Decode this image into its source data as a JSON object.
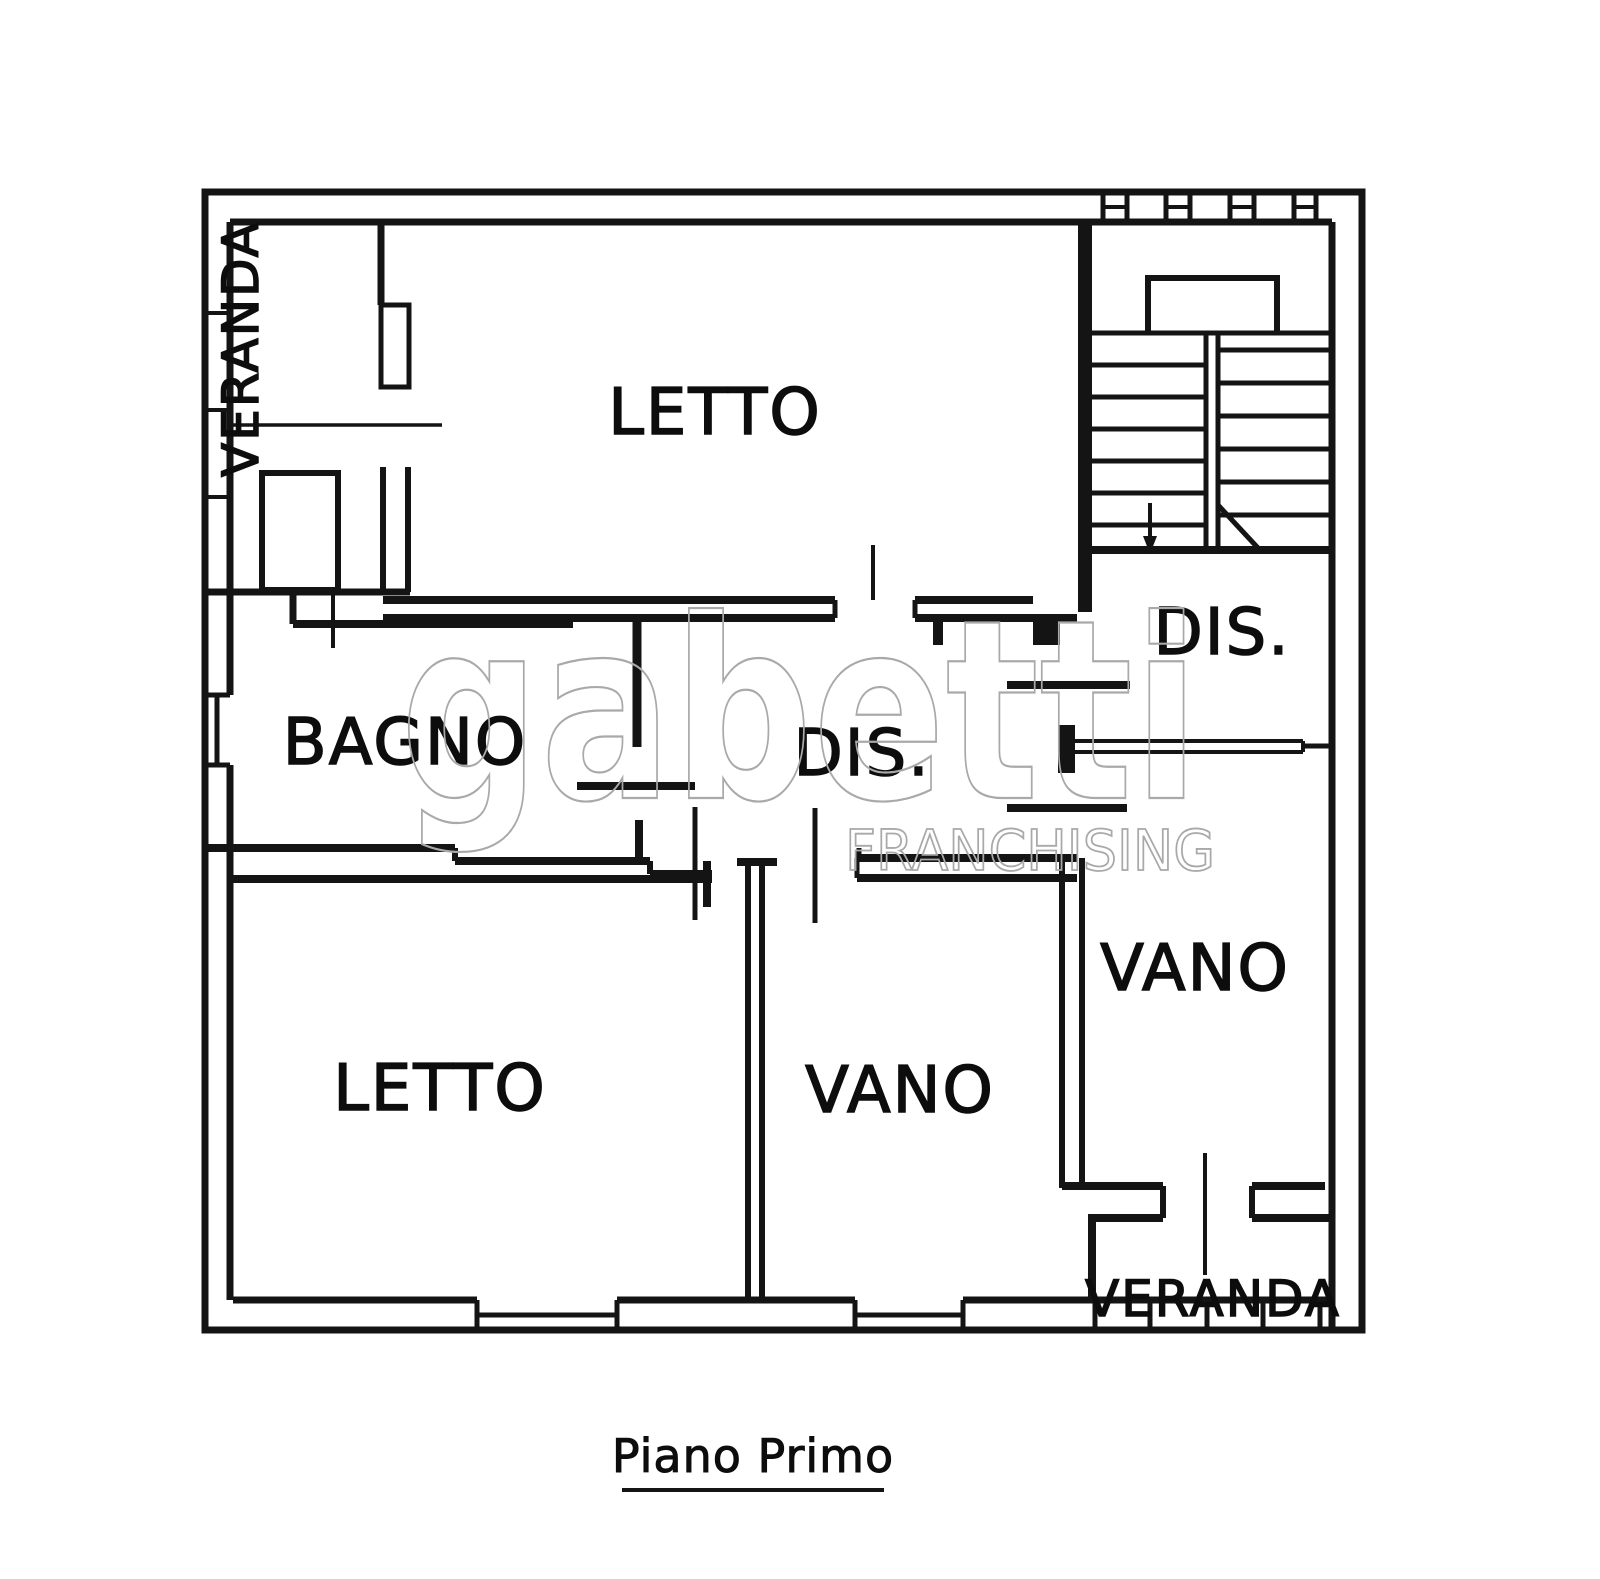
{
  "floor_plan": {
    "caption": "Piano Primo",
    "rooms": {
      "veranda_top_left": "VERANDA",
      "letto_top": "LETTO",
      "dis_right": "DIS.",
      "bagno": "BAGNO",
      "dis_center": "DIS.",
      "letto_bottom": "LETTO",
      "vano_center": "VANO",
      "vano_right": "VANO",
      "veranda_bottom_right": "VERANDA"
    },
    "watermark": {
      "brand": "gabetti",
      "subtitle": "FRANCHISING",
      "color": "#a9a9a9"
    },
    "colors": {
      "ink": "#141414",
      "label": "#0d0d0d",
      "background": "#ffffff"
    }
  }
}
